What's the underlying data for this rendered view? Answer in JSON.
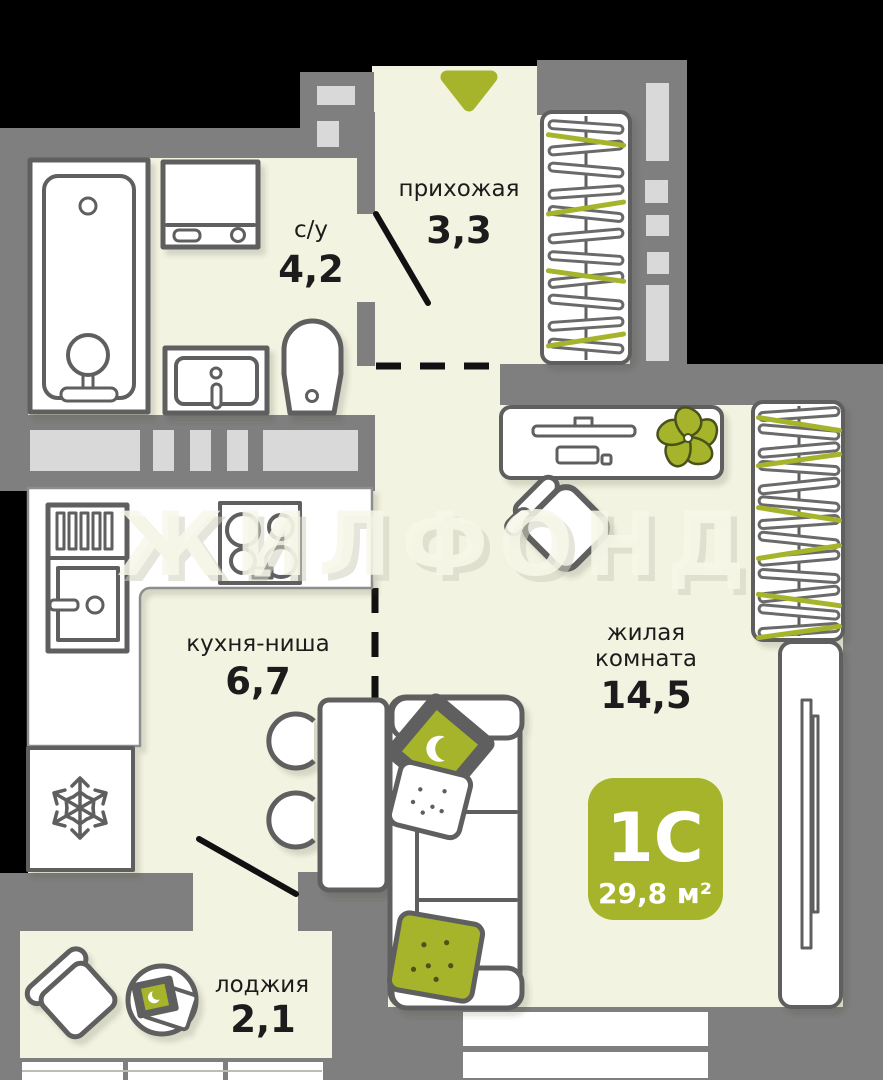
{
  "plan": {
    "watermark": "ЖИЛФОНД",
    "badge": {
      "plan_type": "1С",
      "total_area": "29,8 м²"
    },
    "rooms": {
      "hallway": {
        "name": "прихожая",
        "area": "3,3"
      },
      "bathroom": {
        "name": "с/у",
        "area": "4,2"
      },
      "kitchen": {
        "name": "кухня-ниша",
        "area": "6,7"
      },
      "living": {
        "name_line1": "жилая",
        "name_line2": "комната",
        "area": "14,5"
      },
      "loggia": {
        "name": "лоджия",
        "area": "2,1"
      }
    },
    "icons": {
      "entrance_arrow": "entrance-arrow-down",
      "fridge": "snowflake-icon",
      "plant": "flower-icon"
    },
    "colors": {
      "accent": "#a5b42a",
      "wall": "#7f7f7f",
      "floor": "#f3f3e2",
      "vent": "#d9d9d9",
      "outline": "#5e5e5e",
      "door": "#111111",
      "label": "#1c1c1c",
      "wm": "#f7f7e9",
      "wmshadow": "#cfcfc0"
    }
  }
}
